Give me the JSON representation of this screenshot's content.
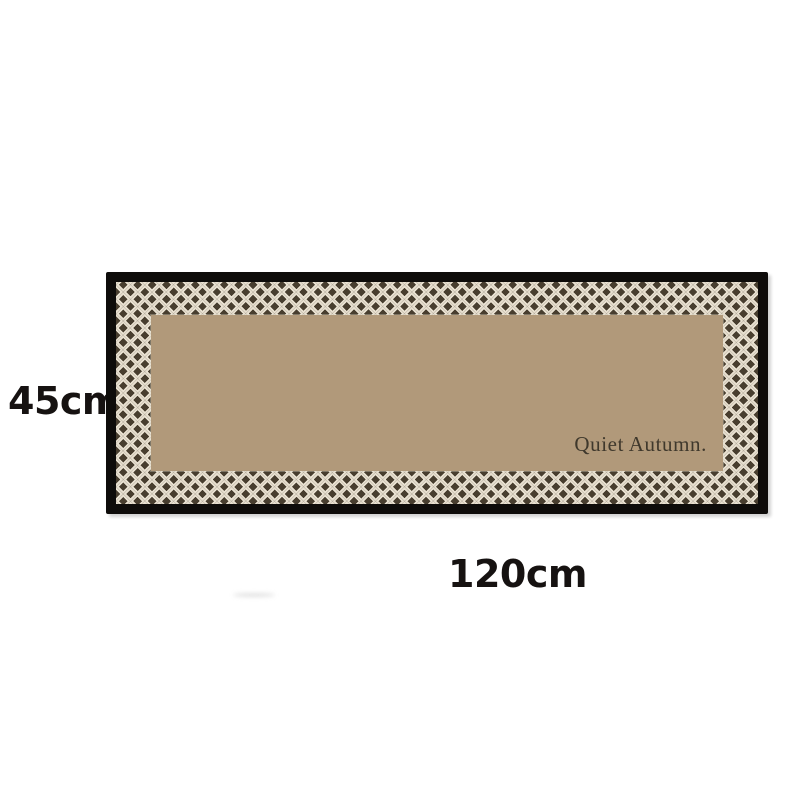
{
  "annotations": {
    "height_label": "45cm",
    "width_label": "120cm"
  },
  "rug": {
    "brand_text": "Quiet Autumn."
  },
  "colors": {
    "background": "#ffffff",
    "border_black": "#0e0c0a",
    "lattice_cream": "#e9e1d1",
    "lattice_brown": "#483e2f",
    "center_tan": "#b1997a",
    "rug_text": "#3f382c",
    "label_text": "#161211"
  }
}
